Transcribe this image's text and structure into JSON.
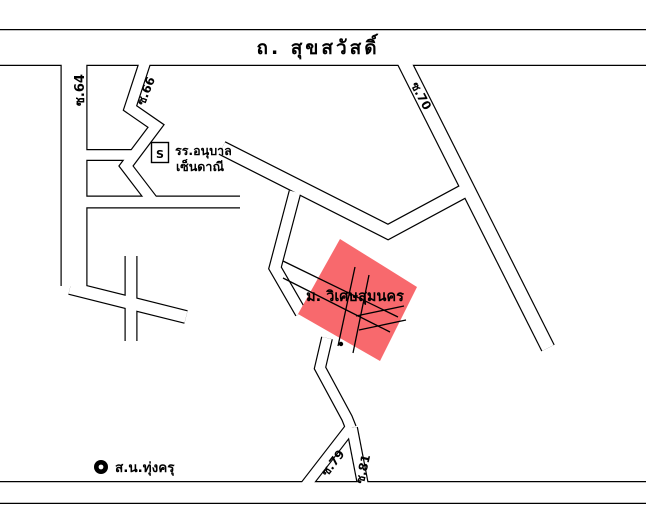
{
  "map": {
    "title": "ถ. สุขสวัสดิ์",
    "roads": {
      "soi64": "ซ.64",
      "soi66": "ซ.66",
      "soi70": "ซ.70",
      "soi79": "ซ.79",
      "soi81": "ซ.81"
    },
    "school": {
      "marker": "S",
      "name_line1": "รร.อนุบาล",
      "name_line2": "เซ็นดาณี"
    },
    "village": {
      "label": "ม. วิเศษสุมนคร",
      "fill": "#f8696d"
    },
    "police": {
      "label": "ส.น.ทุ่งครุ"
    },
    "colors": {
      "line": "#000000",
      "background": "#ffffff"
    }
  }
}
